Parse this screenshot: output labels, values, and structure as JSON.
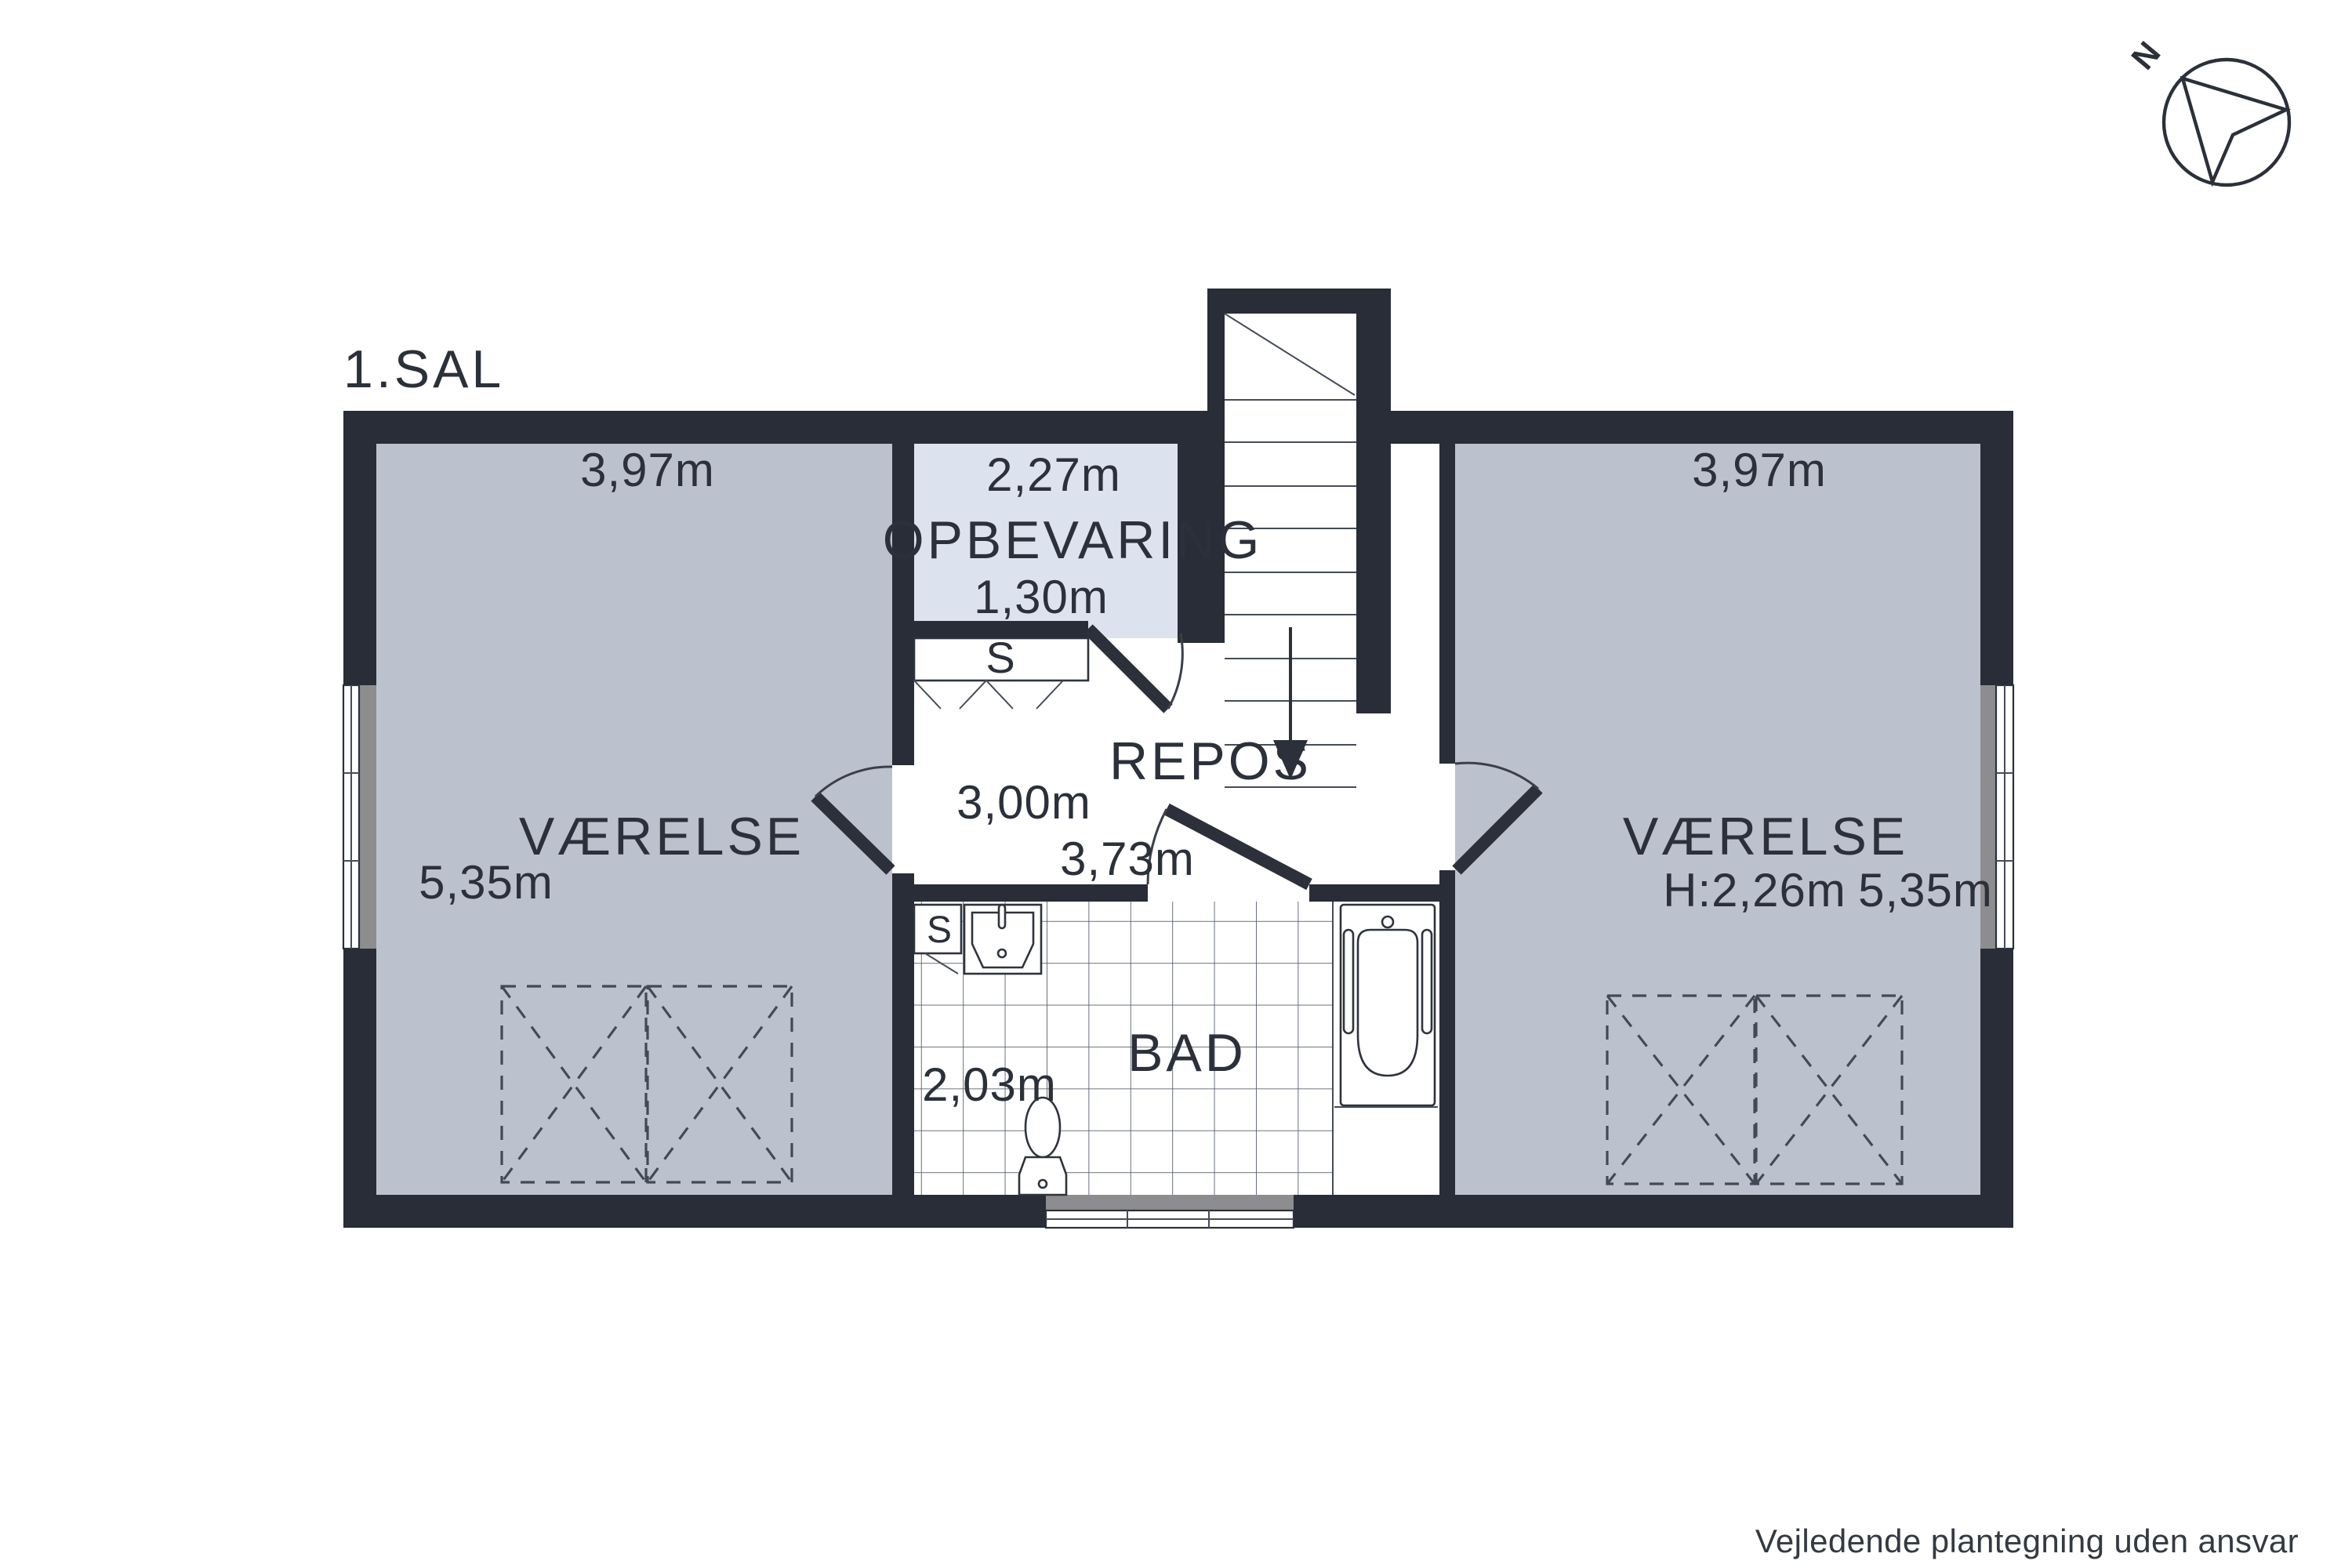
{
  "title": "1.SAL",
  "compass": {
    "label": "N"
  },
  "rooms": {
    "left": {
      "name": "VÆRELSE",
      "width": "3,97m",
      "length": "5,35m"
    },
    "storage": {
      "name": "OPBEVARING",
      "width": "2,27m",
      "depth": "1,30m"
    },
    "landing": {
      "name": "REPOS",
      "width": "3,00m",
      "length": "3,73m"
    },
    "bath": {
      "name": "BAD",
      "width": "2,03m",
      "closet_label": "S"
    },
    "hall_closet": {
      "label": "S"
    },
    "right": {
      "name": "VÆRELSE",
      "width": "3,97m",
      "ceiling_height": "H:2,26m",
      "length": "5,35m"
    }
  },
  "footer": {
    "disclaimer": "Vejledende plantegning uden ansvar"
  },
  "colors": {
    "wall": "#282d37",
    "room_fill": "#bcc2cd",
    "storage_fill": "#dde3ee",
    "window_sill": "#8d8d8f",
    "line": "#2e333d",
    "text": "#2b303a"
  }
}
